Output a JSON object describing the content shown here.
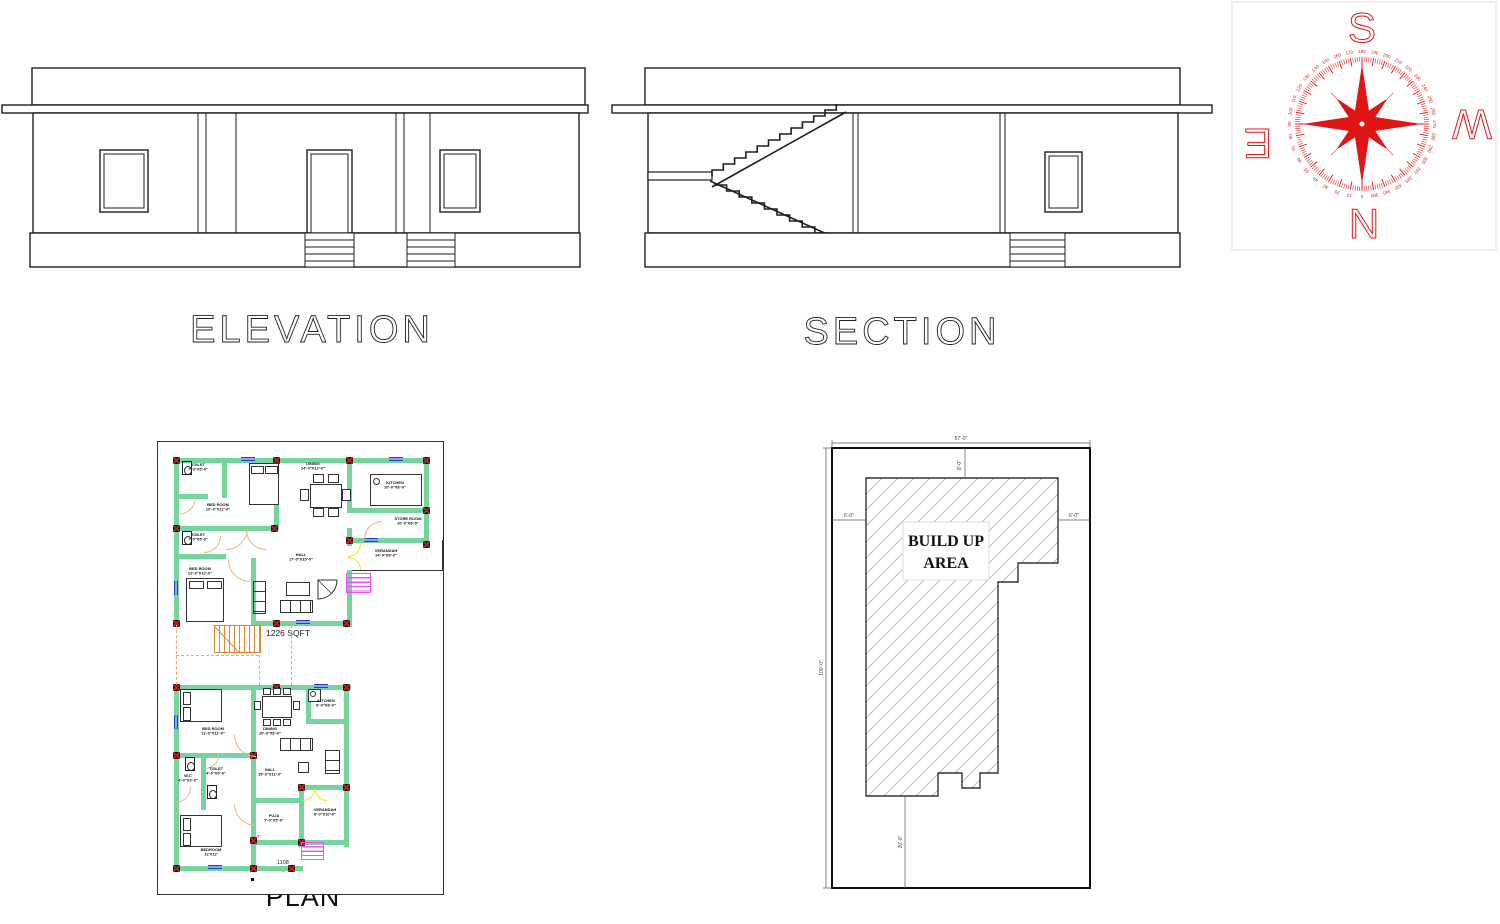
{
  "titles": {
    "elevation": "ELEVATION",
    "section": "SECTION",
    "plan": "PLAN"
  },
  "compass": {
    "letter_top": "S",
    "letter_bottom": "N",
    "letter_left": "E",
    "letter_right": "W",
    "degrees": [
      0,
      10,
      20,
      30,
      40,
      50,
      60,
      70,
      80,
      90,
      100,
      110,
      120,
      130,
      140,
      150,
      160,
      170,
      180,
      190,
      200,
      210,
      220,
      230,
      240,
      250,
      260,
      270,
      280,
      290,
      300,
      310,
      320,
      330,
      340,
      350
    ],
    "color": "#e01616"
  },
  "plan": {
    "area_upper": "1226 SQFT",
    "area_lower_line1": "1108",
    "area_lower_line2": "SQFT",
    "dim_note": "2'-9\"",
    "table_label": "6'-0\" X 3'-0\"",
    "rooms": {
      "toilet1": {
        "name": "TOILET",
        "dims": "7'-0\"X5'-0\""
      },
      "bedroom1": {
        "name": "BED ROOM",
        "dims": "10'-0\"X12'-0\""
      },
      "dining1": {
        "name": "DINING",
        "dims": "14'-0\"X12'-0\""
      },
      "kitchen1": {
        "name": "KITCHEN",
        "dims": "10'-0\"X8'-0\""
      },
      "store": {
        "name": "STORE ROOM",
        "dims": "10'-0\"X5'-0\""
      },
      "toilet2": {
        "name": "TOILET",
        "dims": "7'-0\"X5'-0\""
      },
      "bedroom2": {
        "name": "BED ROOM",
        "dims": "12'-0\"X12'-0\""
      },
      "hall1": {
        "name": "HALL",
        "dims": "17'-0\"X15'-0\""
      },
      "verandah1": {
        "name": "VERANDAH",
        "dims": "14'-0\"X8'-0\""
      },
      "bedroom3": {
        "name": "BED ROOM",
        "dims": "11'-0\"X11'-0\""
      },
      "dining2": {
        "name": "DINING",
        "dims": "10'-0\"X8'-0\""
      },
      "kitchen2": {
        "name": "KITCHEN",
        "dims": "6'-0\"X8'-0\""
      },
      "hall2": {
        "name": "HALL",
        "dims": "15'-0\"X11'-0\""
      },
      "wc": {
        "name": "W.C",
        "dims": "4'-0\"X3'-0\""
      },
      "toilet3": {
        "name": "TOILET",
        "dims": "4'-0\"X6'-0\""
      },
      "bedroom4": {
        "name": "BEDROOM",
        "dims": "12'X12'"
      },
      "puja": {
        "name": "PUJA",
        "dims": "7'-0\"X5'-0\""
      },
      "verandah2": {
        "name": "VERANDAH",
        "dims": "8'-0\"X10'-0\""
      }
    },
    "colors": {
      "wall": "#74d69e",
      "column_bg": "#161616",
      "column_x": "#c41f1f",
      "window": "#2b3fd6",
      "door": "#e5b97f",
      "double_door": "#efe51e",
      "steps": "#f052f0",
      "stair": "#e0872f",
      "stair_dash": "#e8a96a"
    }
  },
  "site": {
    "label_line1": "BUILD UP",
    "label_line2": "AREA",
    "dims": {
      "top": "57'-0\"",
      "top_inner": "8'-0\"",
      "left_side": "6'-0\"",
      "right_side": "6'-0\"",
      "left_outer": "100'-0\"",
      "bottom_inner": "20'-0\""
    }
  }
}
